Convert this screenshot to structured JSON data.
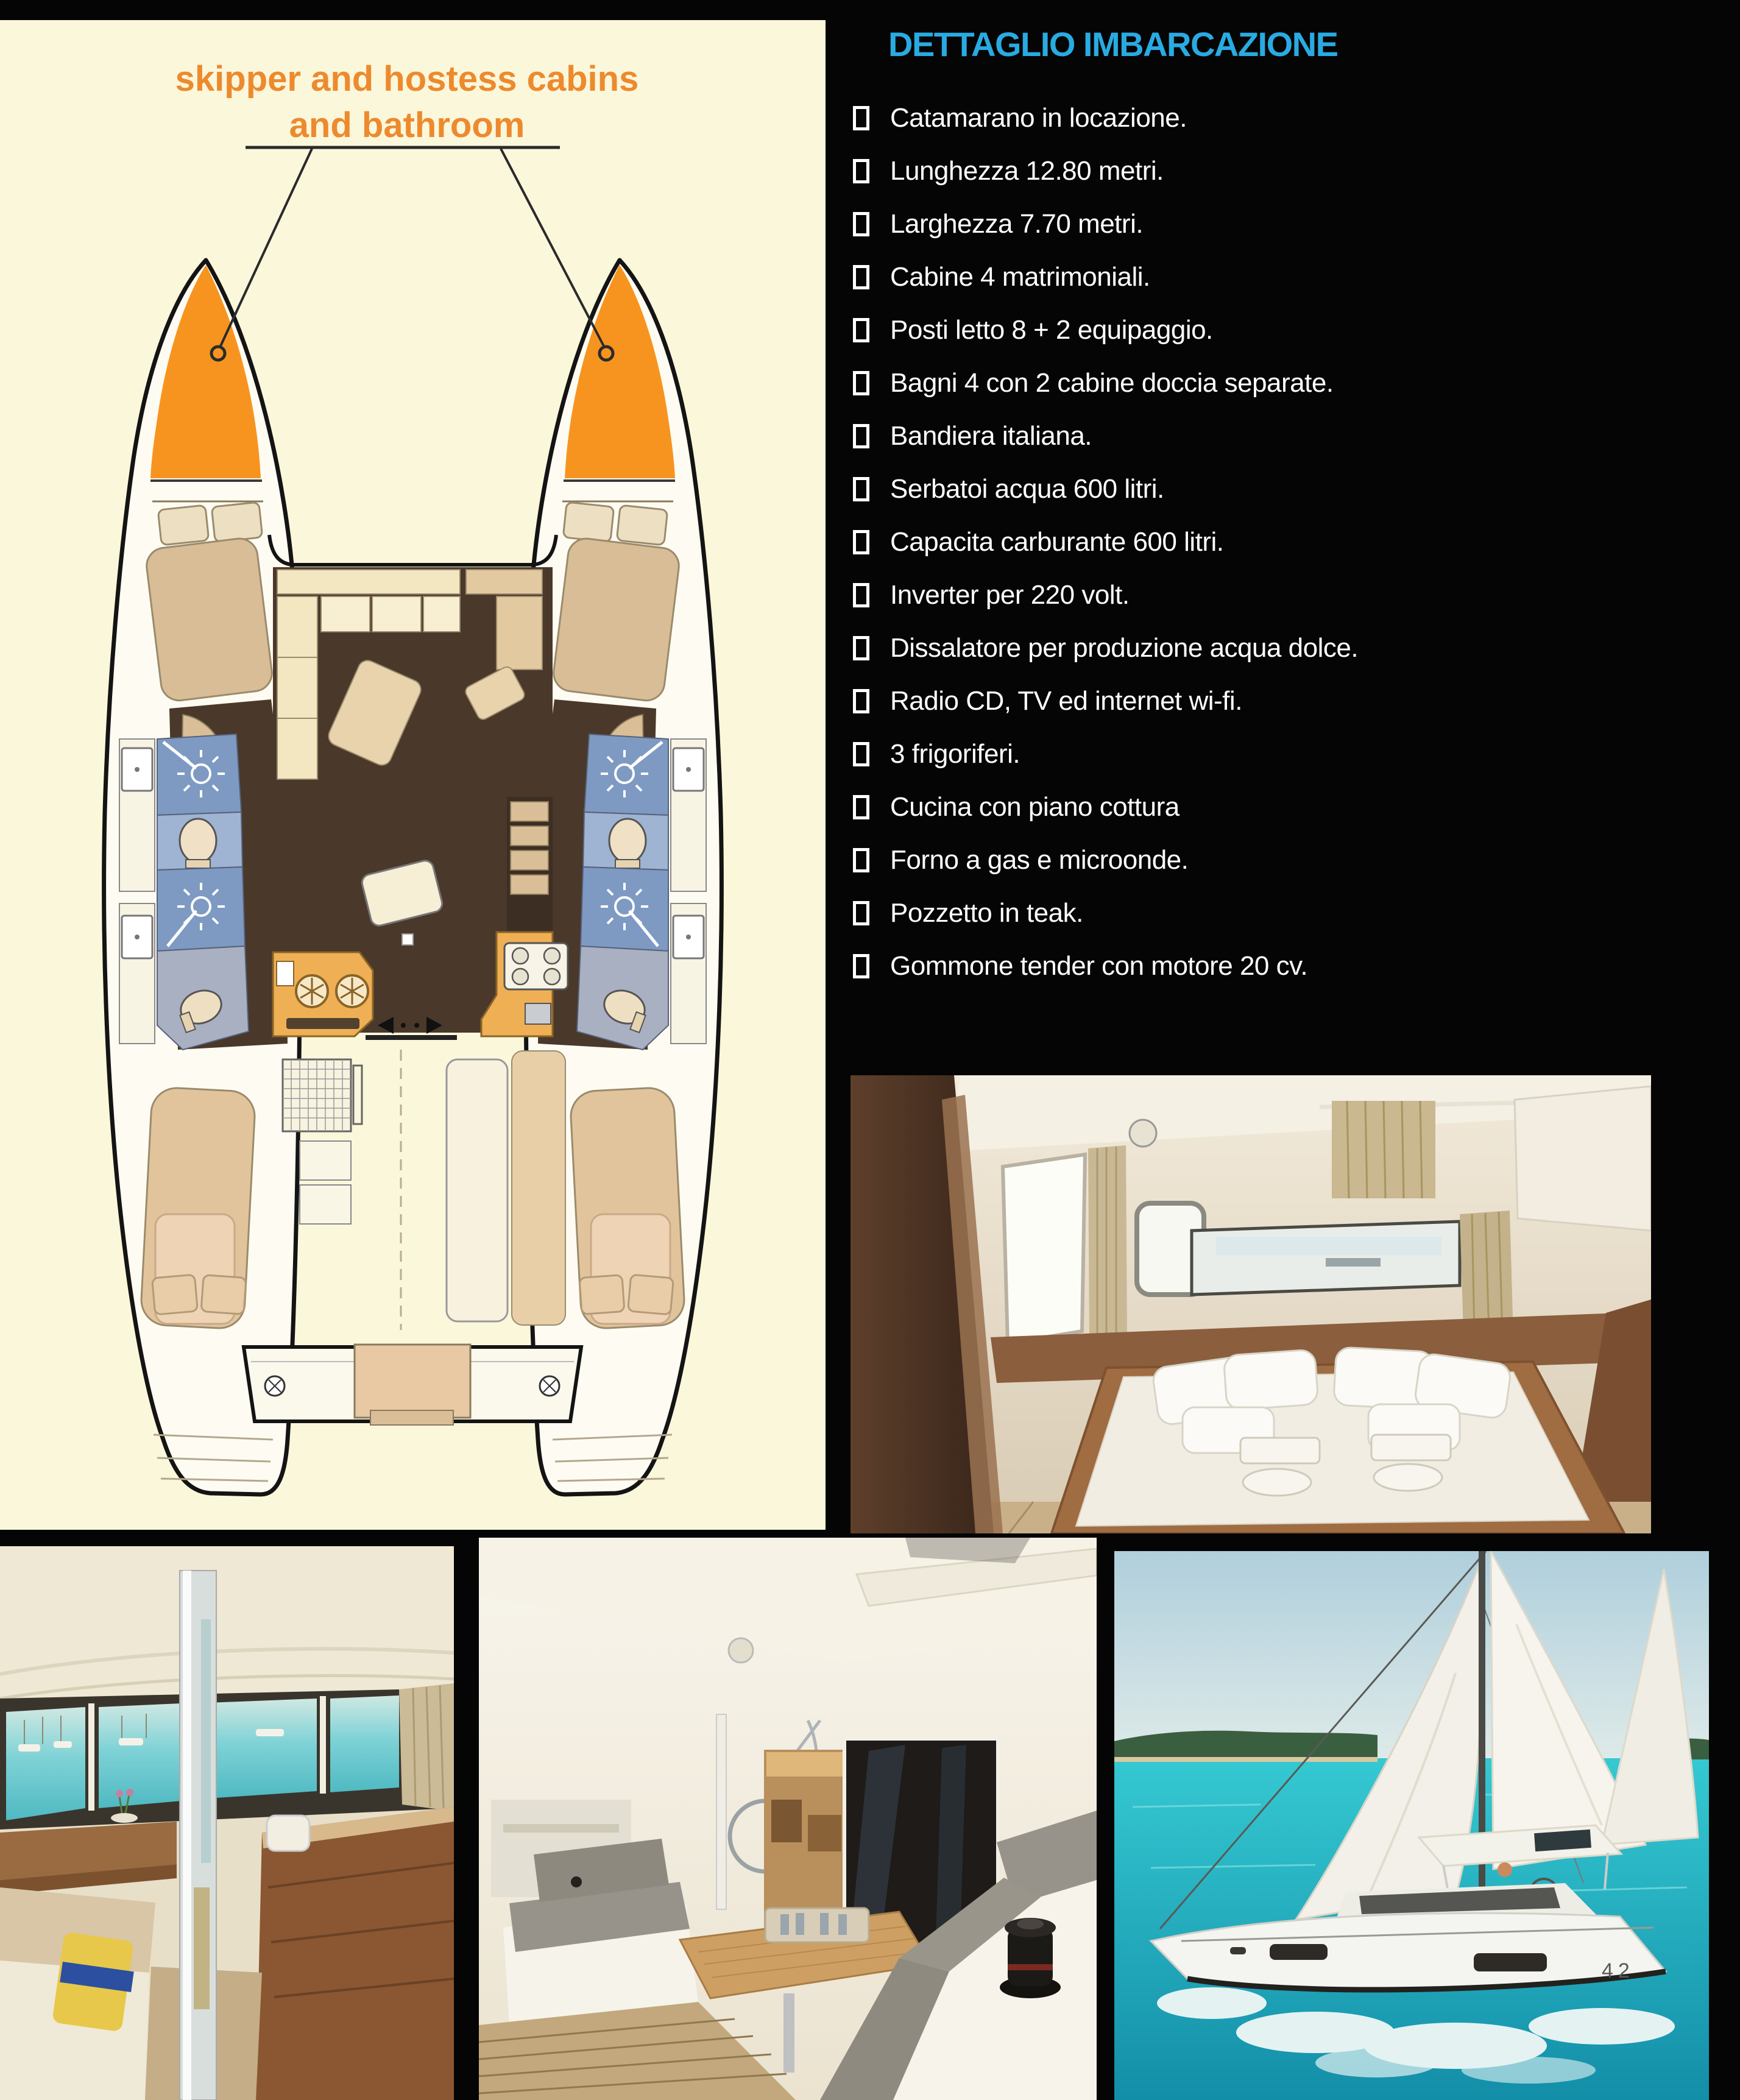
{
  "page": {
    "background": "#050505"
  },
  "floorplan": {
    "background": "#FBF7DB",
    "label_line1": "skipper and hostess cabins",
    "label_line2": "and bathroom",
    "label_color": "#ED8A2E",
    "bow_color": "#F79420",
    "description": "catamaran deck plan, top view"
  },
  "details": {
    "title": "DETTAGLIO IMBARCAZIONE",
    "title_color": "#29ABE2",
    "items": [
      "Catamarano in locazione.",
      "Lunghezza 12.80 metri.",
      "Larghezza 7.70 metri.",
      "Cabine 4 matrimoniali.",
      "Posti letto 8 + 2 equipaggio.",
      "Bagni 4 con 2 cabine doccia separate.",
      "Bandiera italiana.",
      "Serbatoi acqua 600 litri.",
      "Capacita carburante 600 litri.",
      "Inverter per 220 volt.",
      "Dissalatore per produzione acqua dolce.",
      "Radio CD, TV ed internet wi-fi.",
      "3 frigoriferi.",
      "Cucina con piano cottura",
      "Forno a gas e microonde.",
      "Pozzetto in teak.",
      "Gommone tender con motore 20 cv."
    ]
  },
  "photos": {
    "cabin": {
      "alt": "double cabin with white bed, pillows and towels"
    },
    "salon": {
      "alt": "salon interior with table and marina view"
    },
    "cockpit": {
      "alt": "bright cockpit with teak table, grey cushions and winch"
    },
    "sailing": {
      "alt": "catamaran under sail on turquoise water",
      "hull_number": "42"
    }
  }
}
